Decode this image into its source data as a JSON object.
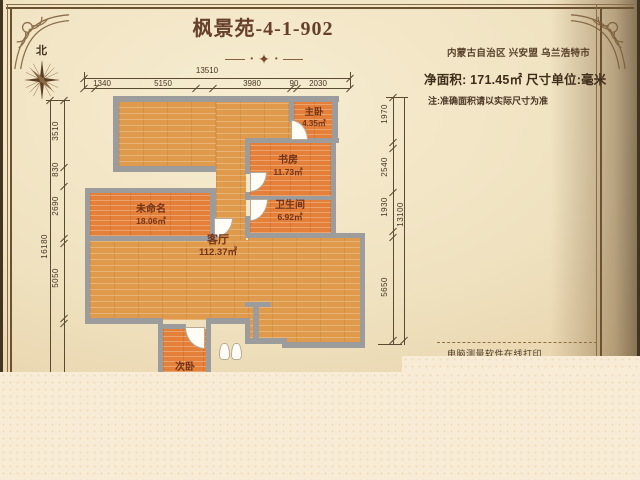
{
  "header": {
    "title": "枫景苑-4-1-902",
    "north": "北",
    "location": "内蒙古自治区 兴安盟 乌兰浩特市",
    "net_area": "净面积: 171.45㎡  尺寸单位:毫米",
    "note": "注:准确面积请以实际尺寸为准"
  },
  "footer": {
    "print_note": "电脑测量软件在线打印."
  },
  "rooms": [
    {
      "name": "主卧",
      "area": "4.35㎡"
    },
    {
      "name": "书房",
      "area": "11.73㎡"
    },
    {
      "name": "卫生间",
      "area": "6.92㎡"
    },
    {
      "name": "未命名",
      "area": "18.06㎡"
    },
    {
      "name": "客厅",
      "area": "112.37㎡"
    },
    {
      "name": "次卧",
      "area": ""
    }
  ],
  "dimensions": {
    "unit": "毫米",
    "top": {
      "total": "13510",
      "segments": [
        "1340",
        "5150",
        "3980",
        "90",
        "2030"
      ]
    },
    "left": {
      "total": "16180",
      "segments": [
        "3510",
        "830",
        "2690",
        "5050"
      ]
    },
    "right": {
      "total": "13100",
      "segments": [
        "1970",
        "2540",
        "1930",
        "5650"
      ]
    }
  },
  "colors": {
    "wall": "#9c9c9c",
    "floor_light": "#df9a4c",
    "floor_deep": "#e4803a",
    "room_label": "#733318",
    "heading": "#66402a",
    "dimension_text": "#443625",
    "parchment": "#f0e2c0",
    "page_bottom": "#f9ecd6"
  }
}
